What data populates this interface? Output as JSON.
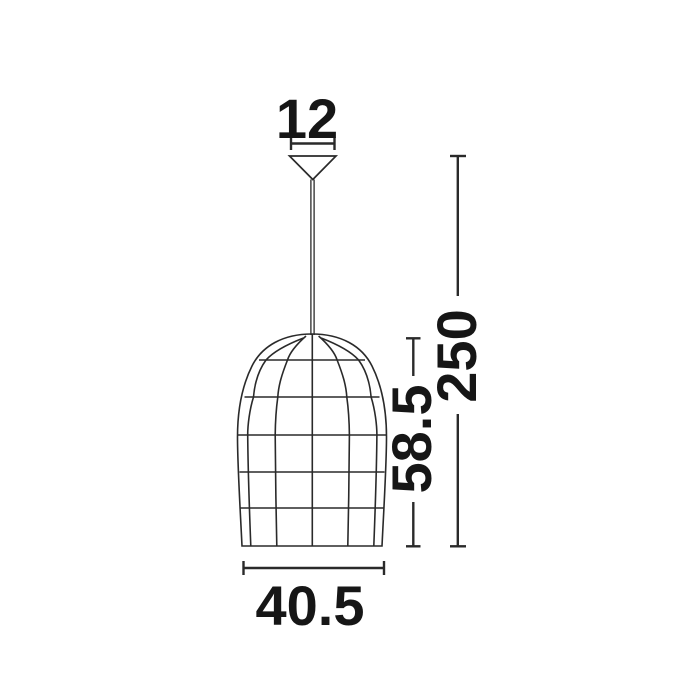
{
  "drawing": {
    "kind": "pendant-lamp-dimension-drawing",
    "dimensions": {
      "canopy_width": "12",
      "shade_width": "40.5",
      "shade_height": "58.5",
      "total_height": "250"
    },
    "colors": {
      "background": "#ffffff",
      "line": "#2a2a2a",
      "text": "#161616"
    }
  }
}
